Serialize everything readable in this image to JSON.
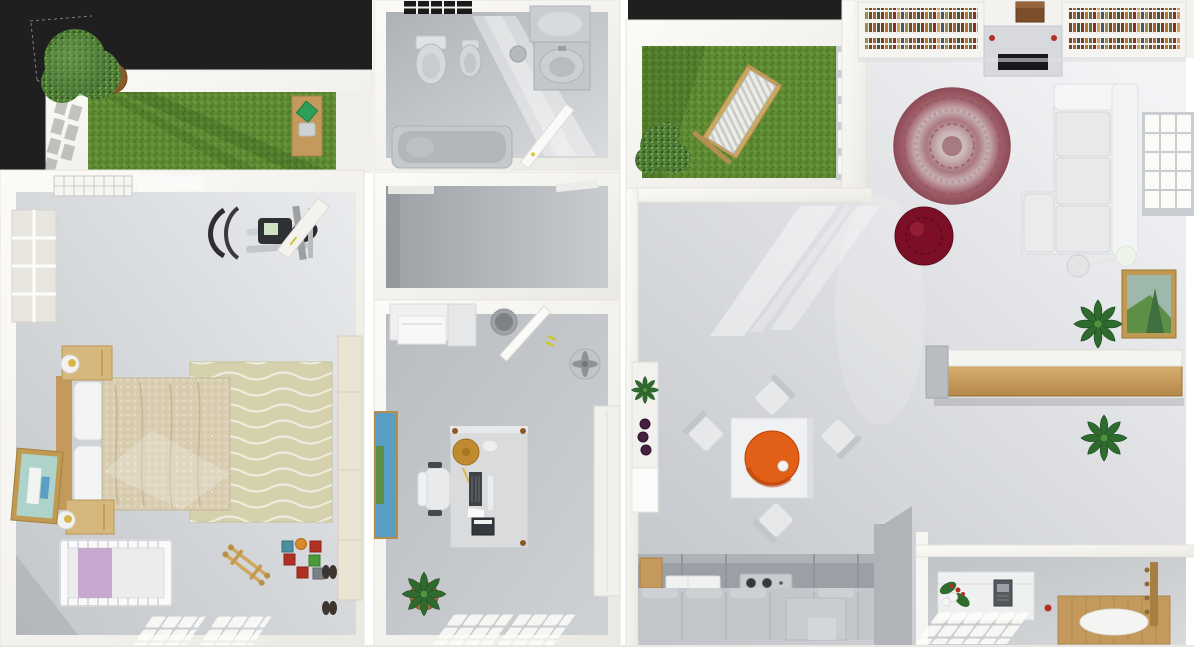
{
  "scene": {
    "description": "3D apartment floor plan viewed from directly above (dollhouse top view)",
    "style": "photorealistic render, white walls, gray floors, dark charcoal backdrop"
  },
  "colors": {
    "backdrop": "#1f1f1f",
    "wallWhite": "#f4f2ee",
    "floorLight": "#f0f1f3",
    "floorDark": "#c6c9cd",
    "corridor": "#a9adb2",
    "grass": "#5e8b33",
    "tree": "#4e7a36",
    "wood": "#c49a5c",
    "woodDark": "#a87f42",
    "sofa": "#eef0f1",
    "rugOuter": "#a2606b",
    "rugInner": "#ddd5d0",
    "pouf": "#7c0f26",
    "pendant": "#e25f17",
    "blanket": "#d9cdb2",
    "bedRug": "#d5d1ad",
    "crib": "#c7a9cf",
    "paintingBlue": "#5a9ec4",
    "paintingGreen": "#5d8f46",
    "paintingTeal": "#aed3cb",
    "gold": "#c09a52",
    "wine": "#45203f",
    "plant": "#2e6b2e",
    "accentYellow": "#d8c832",
    "accentRed": "#b03024",
    "counter": "#9ba0a5",
    "applianceDark": "#33363a",
    "greenCushion": "#2e9e5b"
  },
  "rooms": [
    {
      "id": "roof-terrace",
      "name": "Roof Terrace",
      "features": [
        "lawn",
        "potted-tree",
        "wooden-desk",
        "green-cushion",
        "chair",
        "sun-shadow-grid",
        "dashed-plot-outline"
      ]
    },
    {
      "id": "bathroom",
      "name": "Bathroom",
      "features": [
        "window",
        "toilet",
        "bidet",
        "mirror",
        "washbasin-cabinet",
        "waste-bin",
        "bathtub",
        "open-door",
        "light-shaft"
      ]
    },
    {
      "id": "garden-terrace",
      "name": "Garden Terrace",
      "features": [
        "lawn",
        "deck-chair",
        "shrub",
        "white-railing"
      ]
    },
    {
      "id": "living-room",
      "name": "Living Room",
      "features": [
        "bookshelf-wall",
        "tv-console",
        "stereo-box",
        "sectional-sofa",
        "round-oriental-rug",
        "red-pouf",
        "floor-lamp",
        "window",
        "framed-landscape-painting",
        "palm-plant-upper",
        "palm-plant-lower",
        "wall-bar-counter"
      ]
    },
    {
      "id": "bedroom",
      "name": "Bedroom",
      "features": [
        "skylight",
        "side-window",
        "elliptical-trainer",
        "leaning-board",
        "double-bed",
        "pillows",
        "nightstand-top",
        "nightstand-bottom",
        "ball-lamps",
        "wavy-rug",
        "baby-crib",
        "wooden-toy",
        "building-blocks",
        "leaning-painting",
        "wardrobe",
        "shoes",
        "floor-light-patches"
      ]
    },
    {
      "id": "hallway",
      "name": "Hallway",
      "features": [
        "door-lintels"
      ]
    },
    {
      "id": "home-office",
      "name": "Home Office",
      "features": [
        "printer-cabinet",
        "waste-bin",
        "open-door",
        "standing-fan",
        "wall-artwork",
        "desk",
        "desk-tray",
        "mug",
        "keyboard",
        "monitor",
        "typewriter",
        "office-chair",
        "potted-plant",
        "wardrobe",
        "floor-light-patch"
      ]
    },
    {
      "id": "dining-kitchen",
      "name": "Dining Room & Kitchen",
      "features": [
        "shelf-with-plant",
        "wine-bottles",
        "square-dining-table",
        "chair-north",
        "chair-west",
        "chair-east",
        "chair-south",
        "orange-pendant-lamp",
        "light-shafts",
        "cutting-board",
        "fridge",
        "cooktop",
        "kitchen-counter",
        "base-cabinets",
        "island",
        "partition-wall"
      ]
    },
    {
      "id": "entryway",
      "name": "Entryway",
      "features": [
        "console-table",
        "flower-arrangement",
        "intercom",
        "floor-light-patch",
        "wooden-mat",
        "oval-rug",
        "coat-rack",
        "red-object"
      ]
    }
  ],
  "counts": {
    "wine_bottles": 3,
    "dining_chairs": 4,
    "cooktop_burners": 4,
    "bed_pillows": 2,
    "book_rows_per_shelf": 3
  }
}
